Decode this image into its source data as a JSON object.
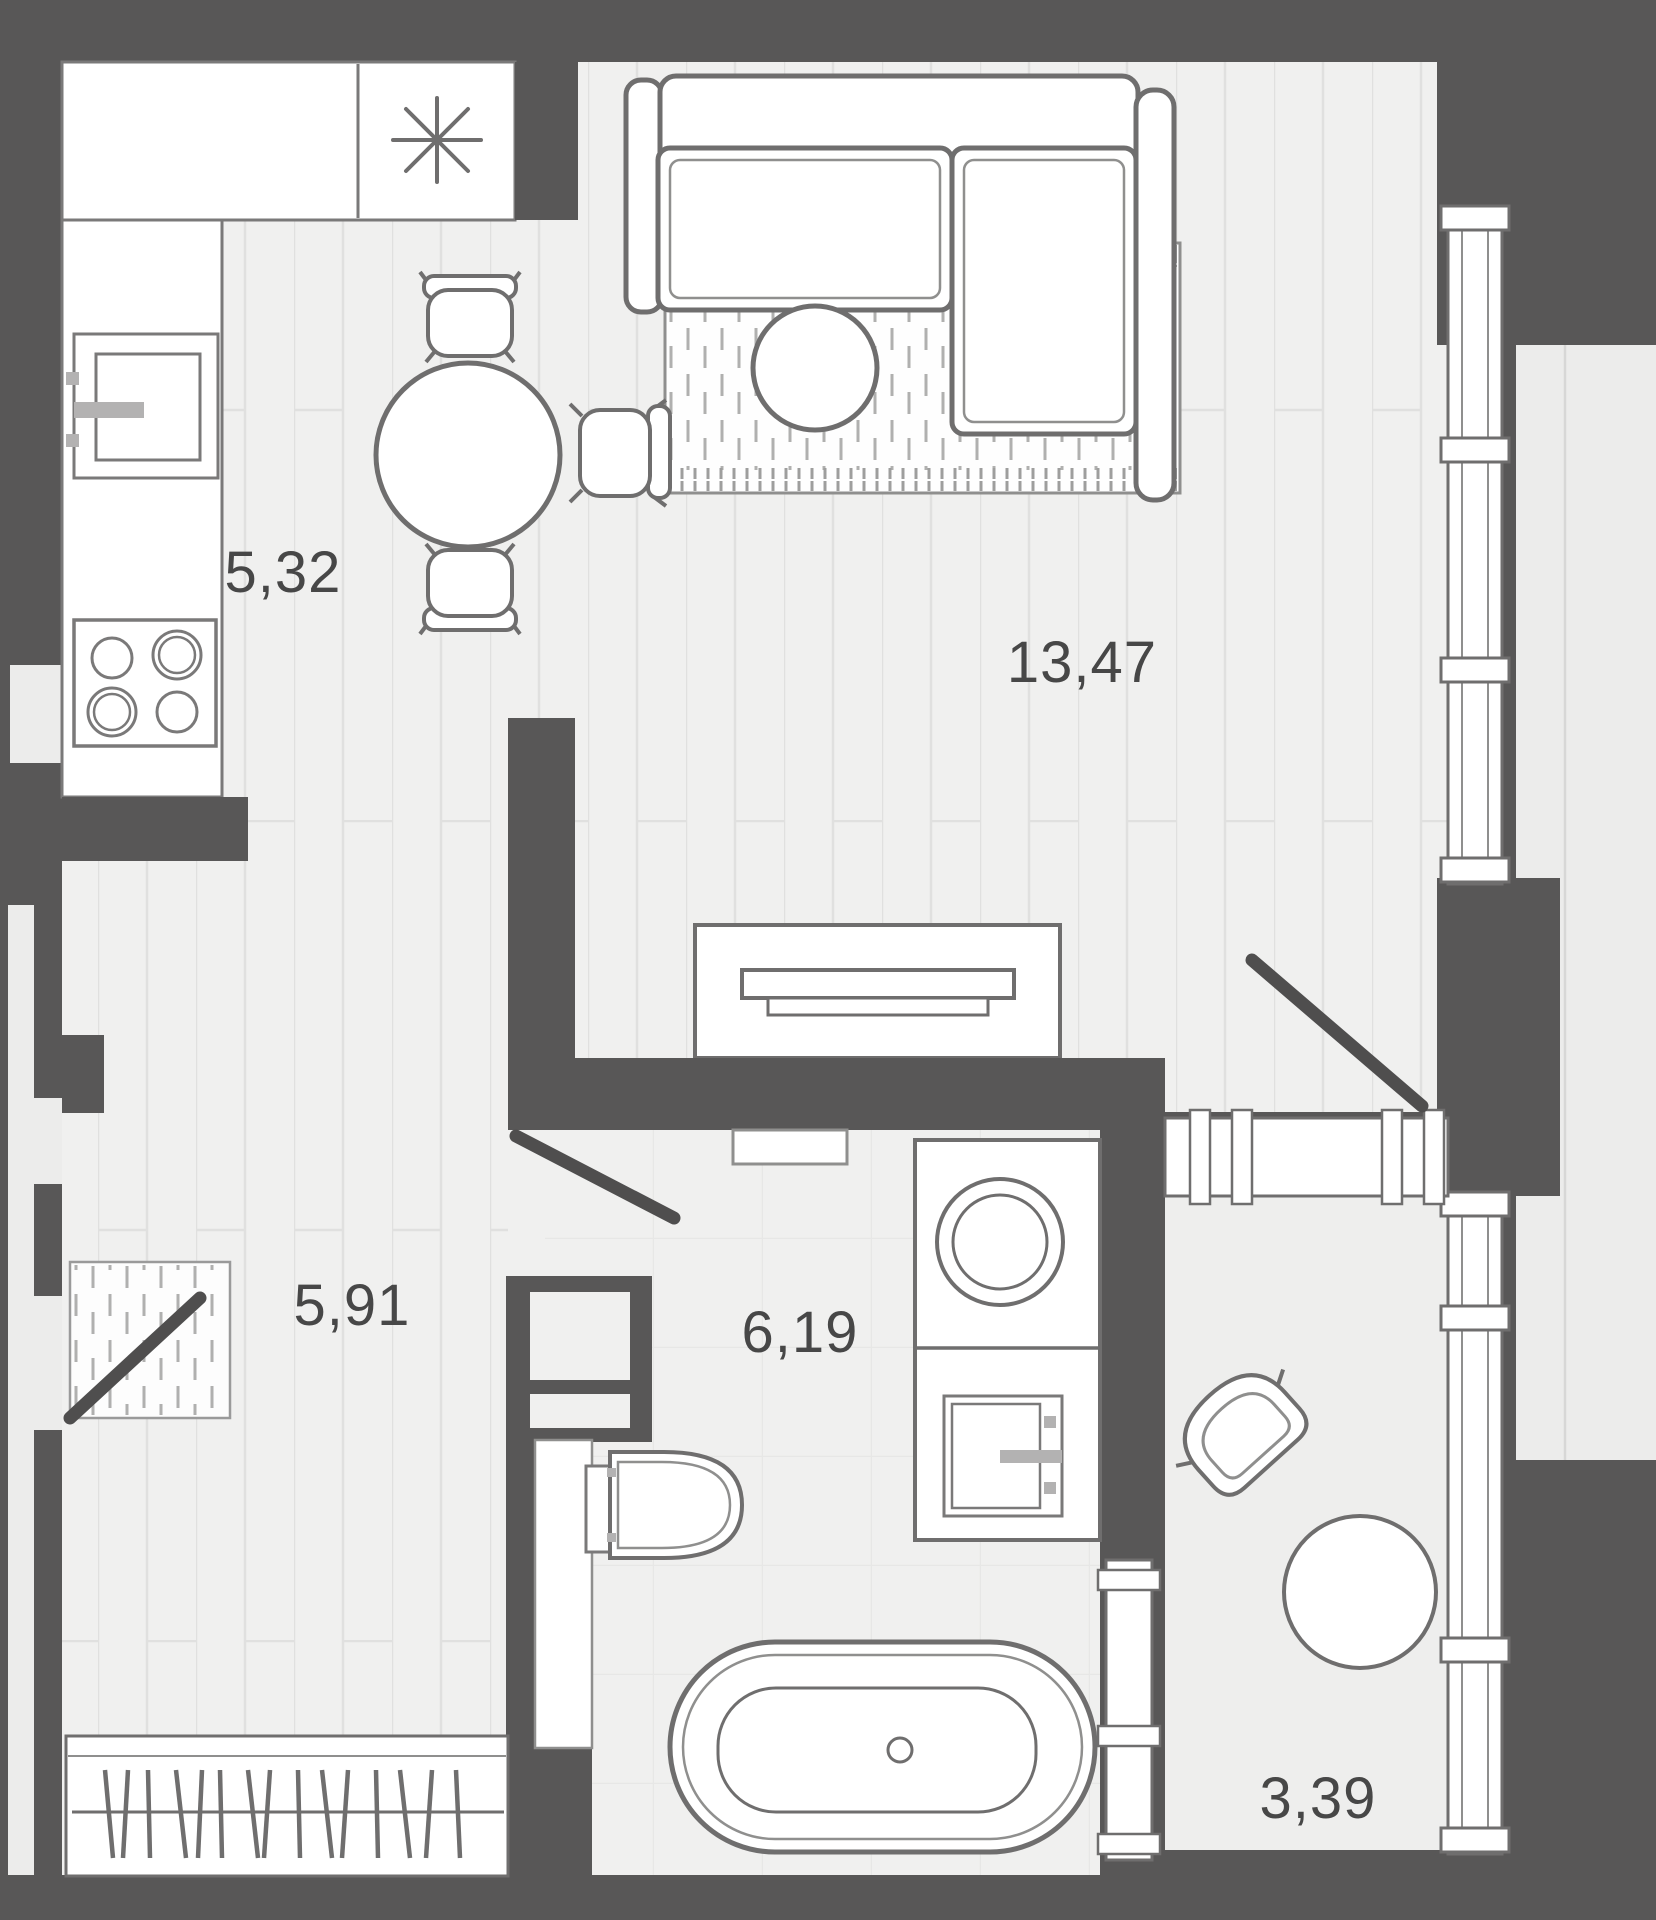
{
  "plan": {
    "type": "apartment-floor-plan",
    "rooms": [
      {
        "id": "kitchen-dining",
        "area": "5,32"
      },
      {
        "id": "living-room",
        "area": "13,47"
      },
      {
        "id": "hallway",
        "area": "5,91"
      },
      {
        "id": "bathroom",
        "area": "6,19"
      },
      {
        "id": "balcony",
        "area": "3,39"
      }
    ],
    "icons": [
      "snowflake-icon (refrigerator)",
      "stove-burners-icon",
      "sink-icon",
      "toilet-icon",
      "bathtub-icon",
      "washing-machine-icon",
      "door-swing-icon",
      "window-icon",
      "wardrobe-hangers-icon"
    ],
    "colors": {
      "wall": "#585757",
      "floor": "#f0f0ef",
      "plank_line": "#e0e0df",
      "tile_line": "#e7e7e6",
      "white": "#ffffff",
      "outline": "#6f6e6e",
      "thin_outline": "#8f8f8e",
      "accent_gray": "#b3b2b2",
      "exterior": "#ececeb",
      "label_text": "#474747"
    }
  }
}
